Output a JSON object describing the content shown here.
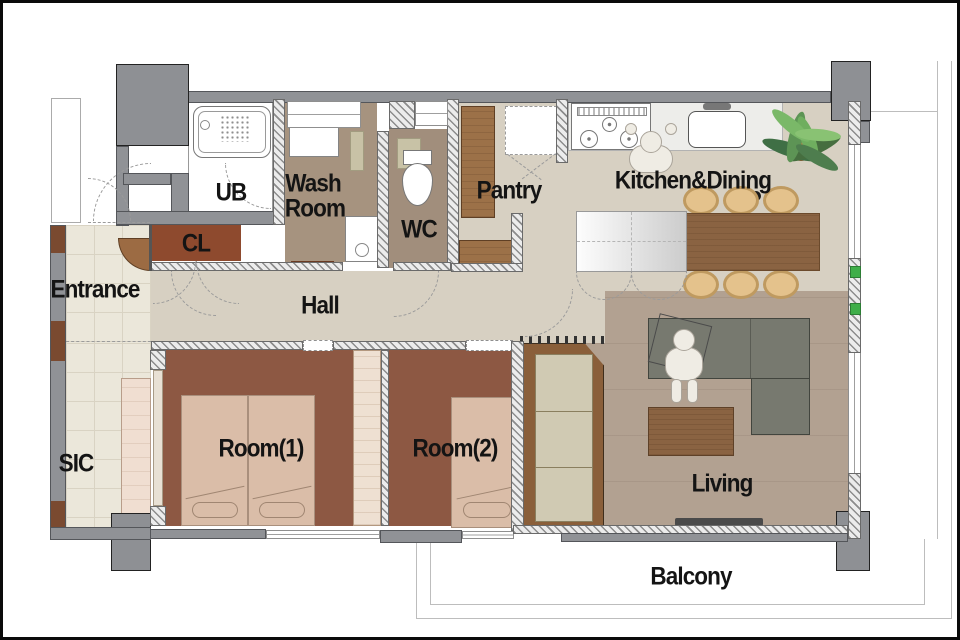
{
  "title": "Apartment floor plan",
  "rooms": {
    "entrance": "Entrance",
    "sic": "SIC",
    "cl": "CL",
    "ub": "UB",
    "wash_room_line1": "Wash",
    "wash_room_line2": "Room",
    "wc": "WC",
    "pantry": "Pantry",
    "hall": "Hall",
    "kitchen_dining": "Kitchen&Dining",
    "living": "Living",
    "room1": "Room(1)",
    "room2": "Room(2)",
    "balcony": "Balcony"
  },
  "colors": {
    "wall": "#909296",
    "pillar": "#8e9094",
    "tile": "#ebe7da",
    "hall_floor": "#d7d0c2",
    "washroom_floor": "#a6937f",
    "wc_floor": "#a18e7c",
    "room_floor": "#8d5843",
    "cl_floor": "#8e4a2e",
    "living_floor": "#b2a191",
    "wood": "#9c7148",
    "table_wood": "#8a6342",
    "chair": "#e4c28c",
    "chair_border": "#bf9a60",
    "sofa": "#77796f",
    "bed": "#dabda8",
    "green": "#3fae49",
    "label_text": "#141414"
  }
}
